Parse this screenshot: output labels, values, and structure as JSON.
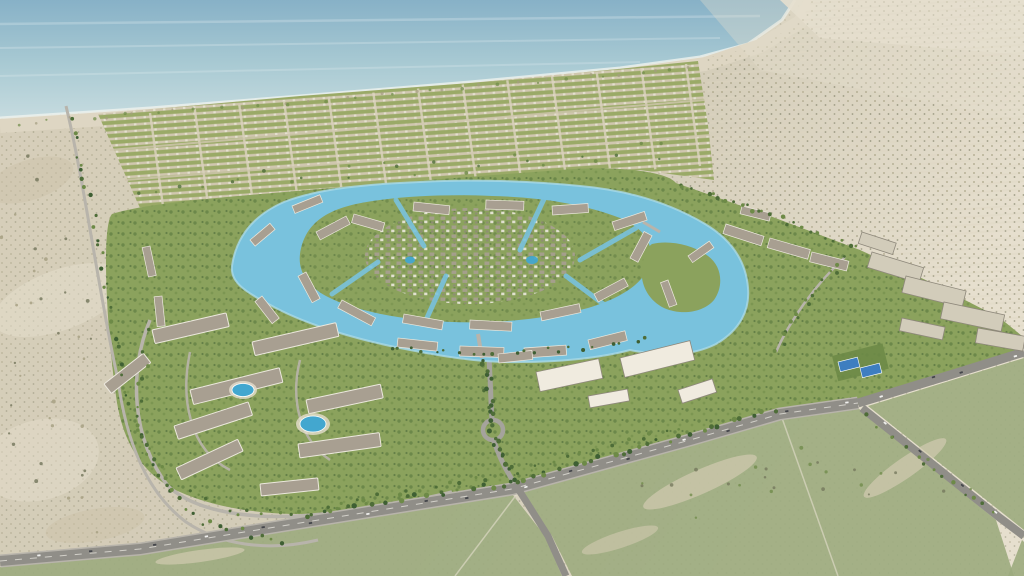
{
  "scene": {
    "kind": "aerial-render",
    "subject": "coastal-masterplan-community",
    "palette": {
      "sea1": "#87b1c7",
      "sea2": "#a9cad3",
      "seaNear": "#c6dbdf",
      "foam": "#eef3ef",
      "beach": "#ded6c3",
      "sandBase": "#d7cfba",
      "sandRight": "#d2cbb7",
      "sandPale": "#e6dfce",
      "sandShadow": "#cbc2a8",
      "scrubDot": "#a49d80",
      "shrubDark": "#72745a",
      "grass": "#8ba25d",
      "grassDark": "#6d8a47",
      "treeDark": "#4e6d38",
      "palmDark": "#3e5f33",
      "villaTan": "#d0c7af",
      "villaGreen": "#9aaa67",
      "villaRoof": "#e9e4d6",
      "gridRoad": "#dad2bc",
      "plotRow": "#ddd6c2",
      "lagoon": "#79c2dd",
      "lagoonLight": "#a9d9e8",
      "roofGray": "#a89f91",
      "roofDark": "#8e887b",
      "wallWhite": "#ece8dd",
      "slabWhite": "#f0ebdf",
      "blockBeige": "#d2ccba",
      "roadGray": "#a5a39c",
      "roadDark": "#908e88",
      "roadLight": "#b8b4ab",
      "roadLine": "#d9d7d0",
      "poolBlue": "#43a7cf",
      "courtBlue": "#3e7ec0",
      "fieldGreen": "#9cab7e",
      "fieldSand": "#d2cab1",
      "vehicleDark": "#43454a",
      "vehicleLight": "#f0f0ee",
      "streakWhite": "#ffffff"
    },
    "generators": {
      "gridColumns": {
        "count": 13,
        "bottom": [
          [
            163,
            206
          ],
          [
            700,
            166
          ]
        ],
        "top": [
          [
            150,
            113
          ],
          [
            686,
            64
          ]
        ],
        "width": 2.4,
        "colorKey": "gridRoad",
        "opacity": 0.85
      },
      "treeLines": [
        {
          "name": "boulevard-treeline",
          "pts": [
            [
              310,
              514
            ],
            [
              512,
              482
            ],
            [
              690,
              433
            ],
            [
              778,
              408
            ]
          ],
          "count": 46,
          "r": 2.1,
          "jitter": 3,
          "colors": [
            "treeDark",
            "palmDark",
            "grassDark"
          ]
        },
        {
          "name": "boulevard-treeline-2",
          "pts": [
            [
              322,
              506
            ],
            [
              510,
              474
            ],
            [
              686,
              426
            ]
          ],
          "count": 28,
          "r": 1.7,
          "jitter": 2.5,
          "colors": [
            "treeDark",
            "grassDark"
          ]
        },
        {
          "name": "avenue-treeline",
          "pts": [
            [
              486,
              360
            ],
            [
              492,
              428
            ],
            [
              516,
              484
            ]
          ],
          "count": 26,
          "r": 2.0,
          "jitter": 5,
          "colors": [
            "palmDark",
            "treeDark"
          ]
        },
        {
          "name": "west-perimeter-treeline",
          "pts": [
            [
              70,
              112
            ],
            [
              100,
              250
            ],
            [
              124,
              392
            ],
            [
              152,
              470
            ],
            [
              204,
              524
            ],
            [
              292,
              544
            ]
          ],
          "count": 48,
          "r": 1.7,
          "jitter": 4,
          "colors": [
            "treeDark",
            "grassDark",
            "palmDark"
          ]
        },
        {
          "name": "northeast-boundary-treeline",
          "pts": [
            [
              676,
              184
            ],
            [
              770,
              216
            ],
            [
              858,
              250
            ]
          ],
          "count": 28,
          "r": 1.8,
          "jitter": 3.5,
          "colors": [
            "treeDark",
            "grassDark"
          ]
        },
        {
          "name": "beach-dune-scrub",
          "pts": [
            [
              10,
              124
            ],
            [
              300,
              102
            ],
            [
              620,
              74
            ],
            [
              700,
              64
            ]
          ],
          "count": 40,
          "r": 1.4,
          "jitter": 2.2,
          "colors": [
            "grassDark",
            "scrubDot"
          ],
          "opacity": 0.7
        },
        {
          "name": "apartment-loop-treeline",
          "pts": [
            [
              150,
              325
            ],
            [
              136,
              420
            ],
            [
              172,
              488
            ],
            [
              242,
              514
            ],
            [
              332,
              510
            ]
          ],
          "count": 30,
          "r": 1.7,
          "jitter": 4,
          "colors": [
            "treeDark",
            "grassDark"
          ]
        },
        {
          "name": "southeast-road-treeline",
          "pts": [
            [
              862,
              412
            ],
            [
              1000,
              520
            ]
          ],
          "count": 14,
          "r": 1.7,
          "jitter": 3,
          "colors": [
            "treeDark",
            "grassDark"
          ]
        },
        {
          "name": "east-internal-treeline",
          "pts": [
            [
              845,
              257
            ],
            [
              800,
              310
            ],
            [
              776,
              352
            ]
          ],
          "count": 16,
          "r": 1.7,
          "jitter": 4,
          "colors": [
            "treeDark",
            "grassDark"
          ]
        },
        {
          "name": "lagoon-south-bank-palms",
          "pts": [
            [
              380,
              346
            ],
            [
              470,
              356
            ],
            [
              590,
              348
            ],
            [
              655,
              338
            ]
          ],
          "count": 22,
          "r": 1.6,
          "jitter": 3,
          "colors": [
            "palmDark",
            "treeDark"
          ]
        },
        {
          "name": "villa-grid-green-specks",
          "pts": [
            [
              130,
              190
            ],
            [
              400,
              170
            ],
            [
              690,
              148
            ]
          ],
          "count": 26,
          "r": 1.5,
          "jitter": 9,
          "colors": [
            "treeDark",
            "grassDark"
          ],
          "opacity": 0.8
        },
        {
          "name": "desert-left-shrubs",
          "pts": [
            [
              20,
              180
            ],
            [
              60,
              300
            ],
            [
              40,
              430
            ],
            [
              90,
              520
            ]
          ],
          "count": 34,
          "r": 1.5,
          "jitter": 38,
          "colors": [
            "shrubDark",
            "scrubDot"
          ],
          "opacity": 0.8
        },
        {
          "name": "parcel-scrub-dots",
          "pts": [
            [
              640,
              500
            ],
            [
              800,
              470
            ],
            [
              950,
              470
            ]
          ],
          "count": 26,
          "r": 1.5,
          "jitter": 26,
          "colors": [
            "shrubDark",
            "grassDark"
          ],
          "opacity": 0.75
        }
      ],
      "vehicleLines": [
        {
          "name": "boulevard-vehicles",
          "pts": [
            [
              4,
              560
            ],
            [
              140,
              549
            ],
            [
              300,
              523
            ],
            [
              512,
              489
            ],
            [
              690,
              440
            ],
            [
              780,
              414
            ],
            [
              856,
              403
            ]
          ],
          "count": 16
        },
        {
          "name": "southeast-branch-vehicles",
          "pts": [
            [
              866,
              410
            ],
            [
              1000,
              518
            ]
          ],
          "count": 4
        },
        {
          "name": "east-branch-vehicles",
          "pts": [
            [
              860,
              401
            ],
            [
              1020,
              353
            ]
          ],
          "count": 4
        }
      ]
    }
  }
}
